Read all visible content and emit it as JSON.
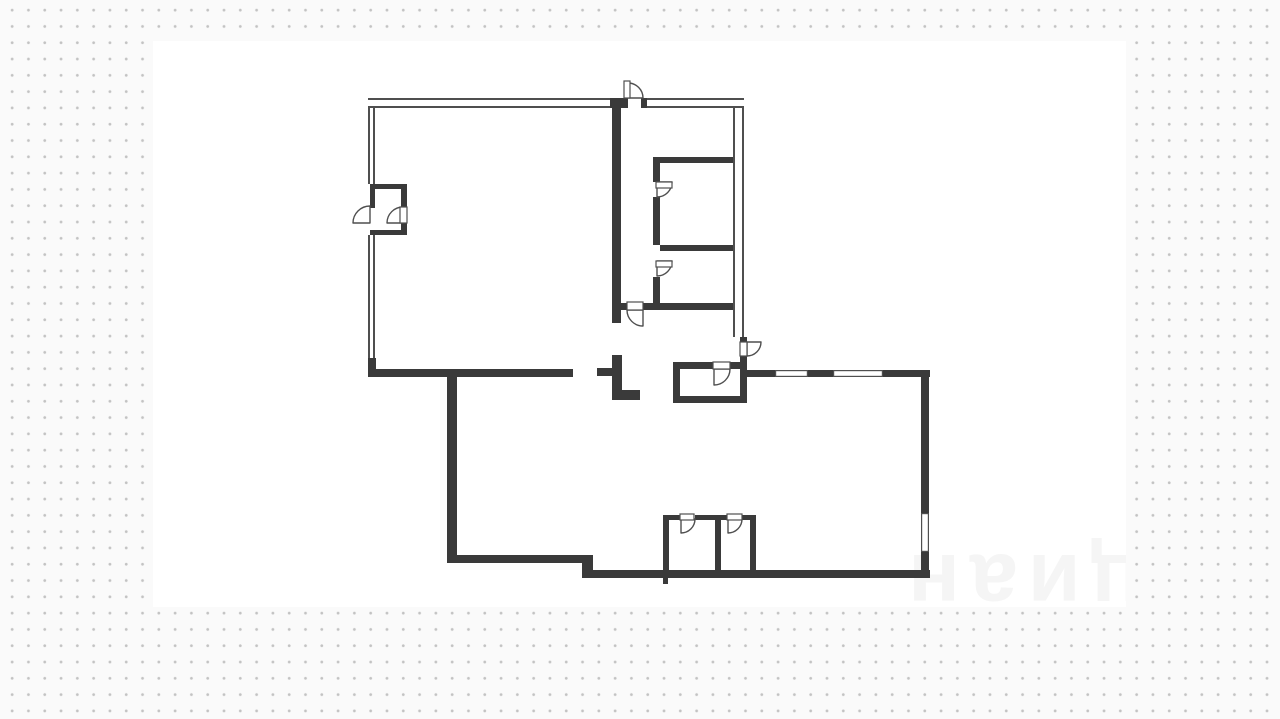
{
  "page": {
    "background_color": "#fafafa",
    "dot_color": "#c3c3c3",
    "card_color": "#ffffff",
    "watermark_text": "циан",
    "wall_color": "#3a3a3a",
    "line_color": "#4f4f4f"
  },
  "card": {
    "x": 153,
    "y": 41,
    "w": 973,
    "h": 566
  },
  "floorplan": {
    "canvas": {
      "w": 1280,
      "h": 719
    },
    "thick_walls": [
      [
        610,
        98,
        18,
        10
      ],
      [
        641,
        98,
        6,
        10
      ],
      [
        612,
        106,
        9,
        217
      ],
      [
        653,
        157,
        80,
        6
      ],
      [
        653,
        163,
        7,
        19
      ],
      [
        653,
        197,
        7,
        48
      ],
      [
        653,
        277,
        7,
        33
      ],
      [
        660,
        245,
        73,
        6
      ],
      [
        621,
        303,
        6,
        7
      ],
      [
        643,
        303,
        90,
        7
      ],
      [
        368,
        358,
        8,
        19
      ],
      [
        368,
        369,
        205,
        8
      ],
      [
        597,
        368,
        15,
        8
      ],
      [
        612,
        355,
        10,
        45
      ],
      [
        622,
        390,
        18,
        10
      ],
      [
        447,
        371,
        10,
        192
      ],
      [
        447,
        555,
        142,
        8
      ],
      [
        582,
        555,
        11,
        23
      ],
      [
        589,
        570,
        341,
        8
      ],
      [
        747,
        370,
        28,
        7
      ],
      [
        808,
        370,
        25,
        7
      ],
      [
        883,
        370,
        47,
        7
      ],
      [
        921,
        370,
        8,
        143
      ],
      [
        921,
        552,
        8,
        26
      ],
      [
        673,
        362,
        40,
        7
      ],
      [
        730,
        362,
        17,
        7
      ],
      [
        673,
        369,
        7,
        34
      ],
      [
        740,
        337,
        7,
        5
      ],
      [
        740,
        356,
        7,
        47
      ],
      [
        673,
        396,
        74,
        7
      ],
      [
        663,
        515,
        17,
        5
      ],
      [
        695,
        515,
        32,
        5
      ],
      [
        742,
        515,
        14,
        5
      ],
      [
        663,
        520,
        6,
        52
      ],
      [
        715,
        520,
        6,
        52
      ],
      [
        750,
        520,
        6,
        52
      ],
      [
        663,
        578,
        5,
        6
      ],
      [
        370,
        184,
        37,
        5
      ],
      [
        401,
        184,
        6,
        23
      ],
      [
        401,
        223,
        6,
        12
      ],
      [
        370,
        230,
        37,
        5
      ],
      [
        370,
        184,
        5,
        24
      ]
    ],
    "thin_walls": [
      [
        368,
        98,
        242,
        10,
        "h"
      ],
      [
        647,
        98,
        97,
        10,
        "h"
      ],
      [
        368,
        106,
        7,
        78,
        "v"
      ],
      [
        368,
        235,
        7,
        123,
        "v"
      ],
      [
        733,
        106,
        11,
        231,
        "v"
      ]
    ],
    "windows": [
      [
        775,
        370,
        33,
        7
      ],
      [
        833,
        370,
        50,
        7
      ],
      [
        921,
        513,
        8,
        39
      ]
    ],
    "doors": [
      {
        "arc": "M628,98 L628,83 A15,15 0 0 1 643,98 Z",
        "leaf": [
          624,
          81,
          6,
          17
        ]
      },
      {
        "arc": "M643,310 L627,310 A16,16 0 0 0 643,326 Z",
        "leaf": [
          627,
          302,
          16,
          8
        ]
      },
      {
        "arc": "M657,182 L672,182 A15,15 0 0 1 657,197 Z",
        "leaf": [
          656,
          182,
          16,
          6
        ]
      },
      {
        "arc": "M657,261 L672,261 A15,15 0 0 1 657,276 Z",
        "leaf": [
          656,
          261,
          16,
          6
        ]
      },
      {
        "arc": "M714,369 L730,369 A16,16 0 0 1 714,385 Z",
        "leaf": [
          713,
          362,
          17,
          7
        ]
      },
      {
        "arc": "M747,342 L761,342 A14,14 0 0 1 747,356 Z",
        "leaf": [
          740,
          342,
          7,
          14
        ]
      },
      {
        "arc": "M370,223 L353,223 A17,17 0 0 1 370,206 Z"
      },
      {
        "arc": "M403,223 L387,223 A16,16 0 0 1 403,207 Z",
        "leaf": [
          400,
          207,
          7,
          16
        ]
      },
      {
        "arc": "M681,519 L695,519 A14,14 0 0 1 681,533 Z",
        "leaf": [
          680,
          514,
          14,
          6
        ]
      },
      {
        "arc": "M728,519 L742,519 A14,14 0 0 1 728,533 Z",
        "leaf": [
          727,
          514,
          15,
          6
        ]
      }
    ]
  }
}
